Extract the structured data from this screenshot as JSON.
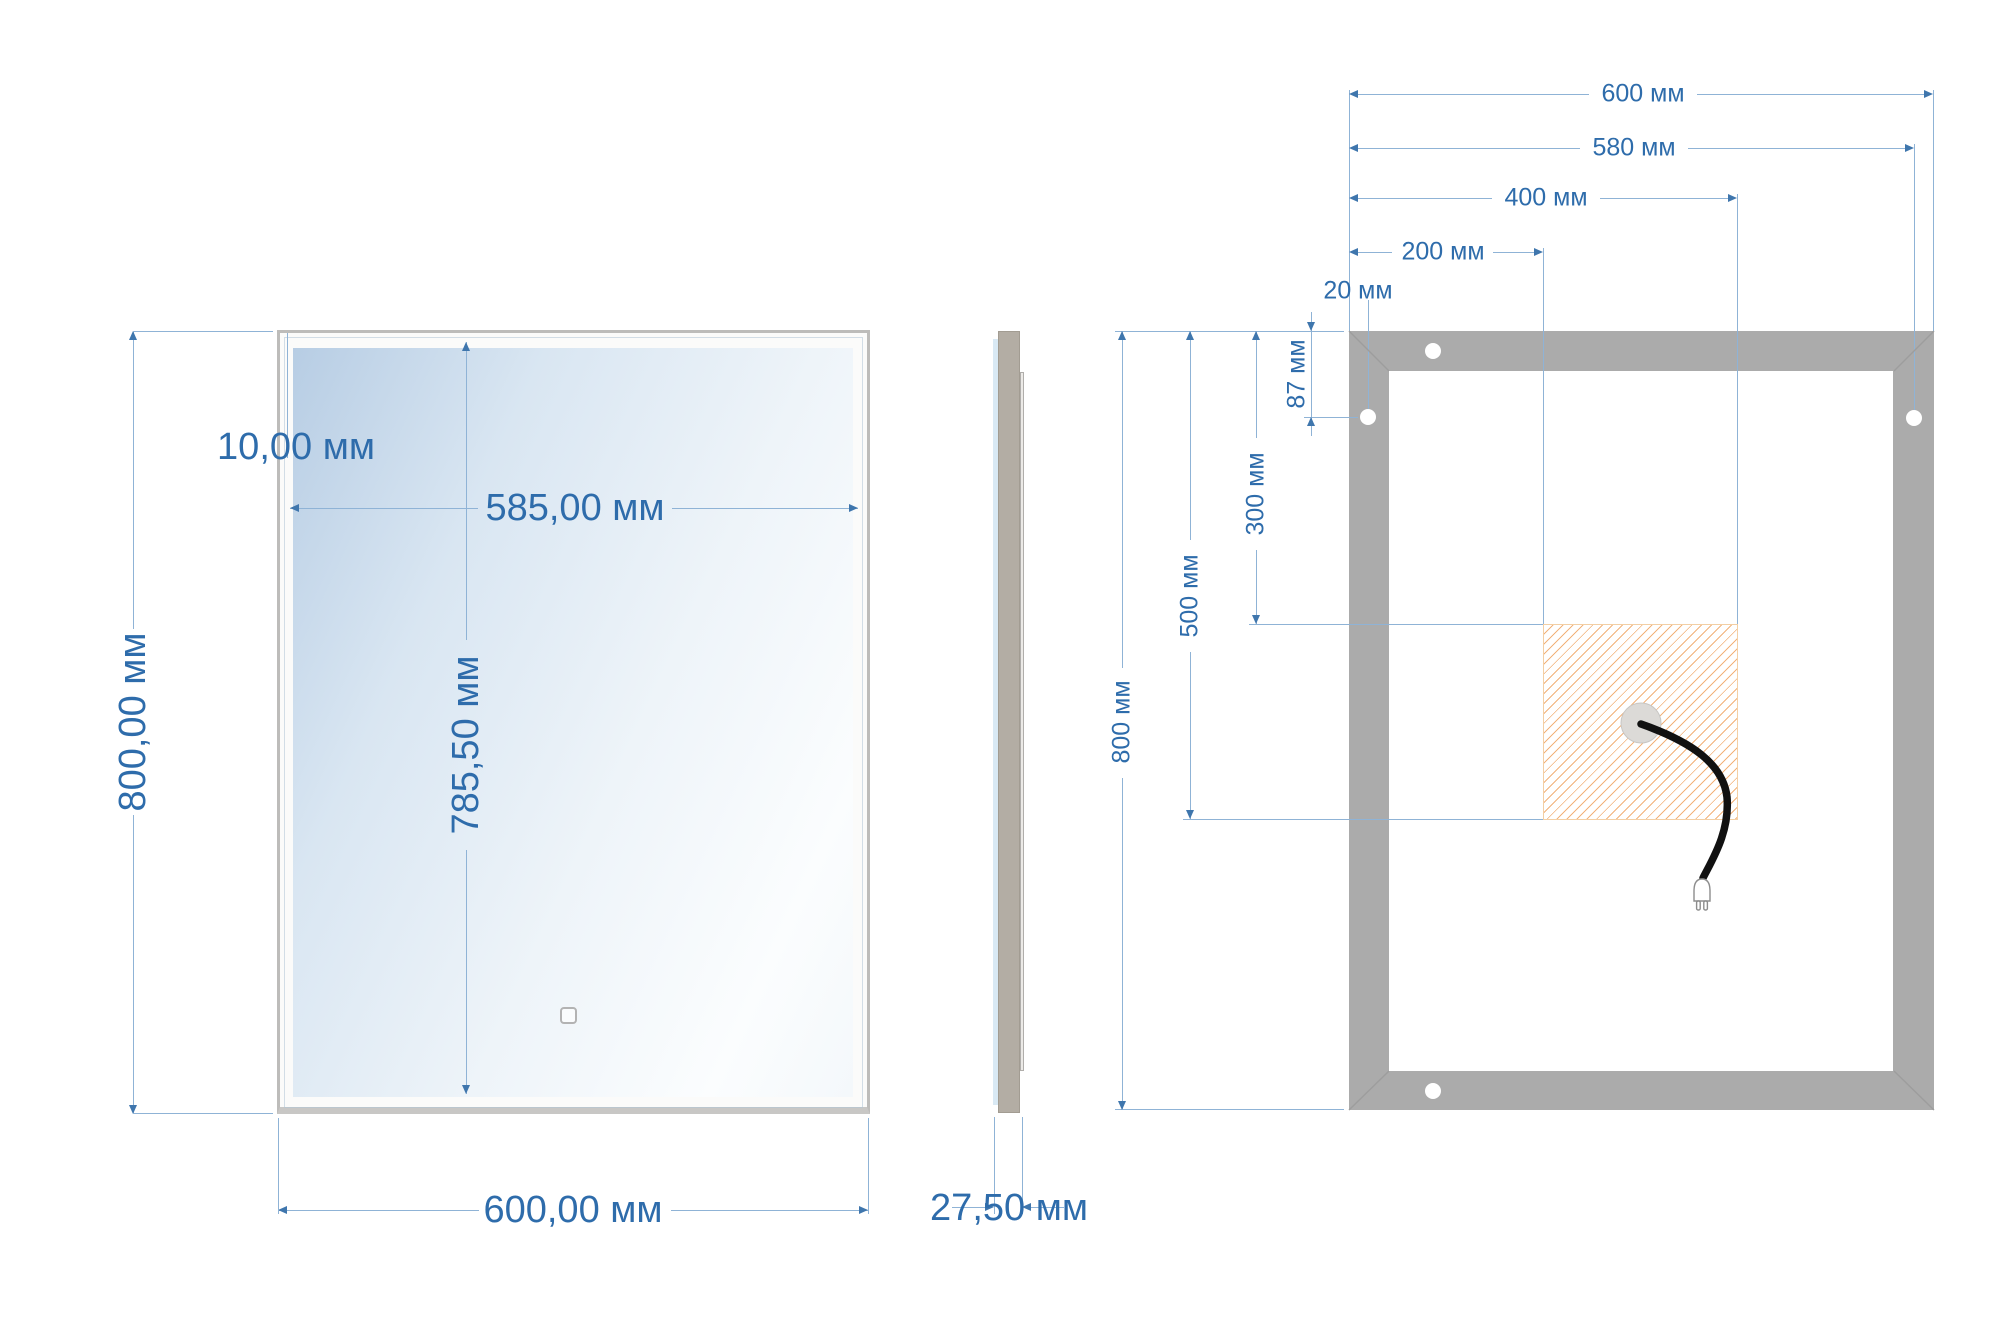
{
  "views": {
    "front": {
      "labels": {
        "height": "800,00 мм",
        "width": "600,00 мм",
        "frame_thickness": "10,00 мм",
        "glass_width": "585,00 мм",
        "glass_height": "785,50 мм"
      }
    },
    "side": {
      "labels": {
        "depth": "27,50 мм"
      }
    },
    "back": {
      "labels": {
        "width": "600 мм",
        "holes_span": "580 мм",
        "driver_zone_right": "400 мм",
        "driver_zone_left": "200 мм",
        "hole_offset_x": "20 мм",
        "hole_offset_y": "87 мм",
        "driver_zone_top": "300 мм",
        "driver_zone_bottom": "500 мм",
        "height": "800 мм"
      }
    }
  },
  "units": "мм",
  "colors": {
    "dimension_text": "#2e6cab",
    "dimension_line": "#8fb3d6",
    "arrow": "#3f76ad",
    "back_frame_gray": "#ababab",
    "side_body_gray": "#b3ada4",
    "front_frame_edge": "#bdbcba",
    "glass_blue": "#b7cde4",
    "hatch_orange": "#f2b27a",
    "cable_black": "#111111"
  },
  "icons": {
    "touch-sensor-icon": "rounded-square",
    "mounting-hole-icon": "white-circle",
    "cable-grommet-icon": "gray-circle",
    "power-cable-icon": "curved-black-line",
    "power-plug-icon": "europlug-two-prongs",
    "led-driver-zone-icon": "diagonal-hatch-square"
  }
}
